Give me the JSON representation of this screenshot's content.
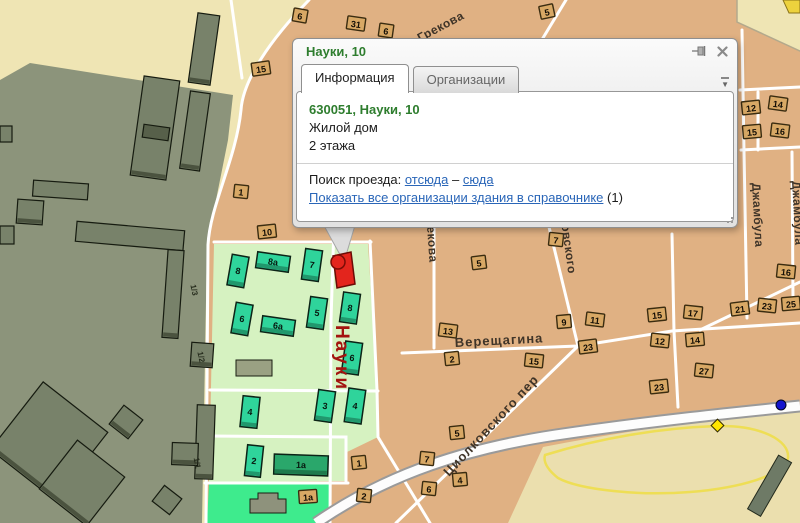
{
  "popup": {
    "title": "Науки, 10",
    "tabs": [
      {
        "label": "Информация",
        "active": true
      },
      {
        "label": "Организации",
        "active": false
      }
    ],
    "address": "630051, Науки, 10",
    "building_type": "Жилой дом",
    "floors": "2 этажа",
    "route_label": "Поиск проезда:",
    "route_from": "отсюда",
    "route_dash": "–",
    "route_to": "сюда",
    "orgs_link": "Показать все организации здания в справочнике",
    "orgs_count": "(1)"
  },
  "colors": {
    "popup_title_green": "#2e7d2e",
    "link_blue": "#2a66b8",
    "street_red": "#a31410",
    "street_dark": "#3f3428",
    "marker_red": "#e3251d",
    "badge_fill": "#d8a865",
    "green_building": "#2fd49b",
    "green_building_dark": "#2aa76b",
    "city_block_tan": "#e0b183",
    "industrial_gray": "#8c947b",
    "residential_green": "#d6f2c1",
    "park_bright_green": "#3eeb8d"
  },
  "map": {
    "street_labels": [
      {
        "t": "Науки",
        "x": 336,
        "y": 325,
        "r": 90,
        "c": "red",
        "s": 19,
        "ls": 2
      },
      {
        "t": "Верещагина",
        "x": 455,
        "y": 347,
        "r": -3,
        "c": "dark",
        "s": 13,
        "ls": 1
      },
      {
        "t": "Циолковского пер",
        "x": 449,
        "y": 477,
        "r": -47,
        "c": "dark",
        "s": 13,
        "ls": 1
      },
      {
        "t": "Циолковского",
        "x": 556,
        "y": 186,
        "r": 82,
        "c": "dark",
        "s": 12,
        "ls": 0.5
      },
      {
        "t": "Грекова",
        "x": 420,
        "y": 42,
        "r": -28,
        "c": "dark",
        "s": 12,
        "ls": 0.5
      },
      {
        "t": "Грекова",
        "x": 426,
        "y": 212,
        "r": 86,
        "c": "dark",
        "s": 12,
        "ls": 0.5
      },
      {
        "t": "Джамбула",
        "x": 752,
        "y": 183,
        "r": 87,
        "c": "dark",
        "s": 12,
        "ls": 0.5
      },
      {
        "t": "Джамбула",
        "x": 792,
        "y": 181,
        "r": 87,
        "c": "dark",
        "s": 12,
        "ls": 0.5
      }
    ],
    "building_badges": [
      {
        "t": "15",
        "x": 261,
        "y": 69,
        "r": -8
      },
      {
        "t": "1",
        "x": 241,
        "y": 192,
        "r": 6
      },
      {
        "t": "10",
        "x": 267,
        "y": 232,
        "r": -6
      },
      {
        "t": "6",
        "x": 300,
        "y": 16,
        "r": 10
      },
      {
        "t": "31",
        "x": 356,
        "y": 24,
        "r": 8
      },
      {
        "t": "6",
        "x": 386,
        "y": 31,
        "r": 8
      },
      {
        "t": "5",
        "x": 547,
        "y": 12,
        "r": -12
      },
      {
        "t": "12",
        "x": 751,
        "y": 108,
        "r": -6
      },
      {
        "t": "14",
        "x": 778,
        "y": 104,
        "r": 8
      },
      {
        "t": "15",
        "x": 752,
        "y": 132,
        "r": -5
      },
      {
        "t": "16",
        "x": 780,
        "y": 131,
        "r": 7
      },
      {
        "t": "5",
        "x": 479,
        "y": 263,
        "r": -7
      },
      {
        "t": "7",
        "x": 556,
        "y": 240,
        "r": 6
      },
      {
        "t": "9",
        "x": 564,
        "y": 322,
        "r": -5
      },
      {
        "t": "11",
        "x": 595,
        "y": 320,
        "r": 7
      },
      {
        "t": "15",
        "x": 657,
        "y": 315,
        "r": -6
      },
      {
        "t": "17",
        "x": 693,
        "y": 313,
        "r": 6
      },
      {
        "t": "21",
        "x": 740,
        "y": 309,
        "r": -7
      },
      {
        "t": "23",
        "x": 767,
        "y": 306,
        "r": 6
      },
      {
        "t": "25",
        "x": 791,
        "y": 304,
        "r": -5
      },
      {
        "t": "13",
        "x": 448,
        "y": 331,
        "r": 7
      },
      {
        "t": "2",
        "x": 452,
        "y": 359,
        "r": -6
      },
      {
        "t": "15",
        "x": 534,
        "y": 361,
        "r": 6
      },
      {
        "t": "23",
        "x": 588,
        "y": 347,
        "r": -7
      },
      {
        "t": "12",
        "x": 660,
        "y": 341,
        "r": 6
      },
      {
        "t": "14",
        "x": 695,
        "y": 340,
        "r": -5
      },
      {
        "t": "27",
        "x": 704,
        "y": 371,
        "r": 6
      },
      {
        "t": "23",
        "x": 659,
        "y": 387,
        "r": -6
      },
      {
        "t": "16",
        "x": 786,
        "y": 272,
        "r": 6
      },
      {
        "t": "5",
        "x": 457,
        "y": 433,
        "r": -6
      },
      {
        "t": "7",
        "x": 427,
        "y": 459,
        "r": 6
      },
      {
        "t": "4",
        "x": 460,
        "y": 480,
        "r": -5
      },
      {
        "t": "6",
        "x": 429,
        "y": 489,
        "r": 6
      },
      {
        "t": "1",
        "x": 359,
        "y": 463,
        "r": -6
      },
      {
        "t": "2",
        "x": 364,
        "y": 496,
        "r": 6
      },
      {
        "t": "1а",
        "x": 308,
        "y": 497,
        "r": -4
      }
    ],
    "green_buildings": [
      {
        "t": "8",
        "x": 238,
        "y": 271,
        "w": 17,
        "h": 31,
        "r": 10
      },
      {
        "t": "8а",
        "x": 273,
        "y": 262,
        "w": 33,
        "h": 16,
        "r": 8
      },
      {
        "t": "7",
        "x": 312,
        "y": 265,
        "w": 17,
        "h": 31,
        "r": 8
      },
      {
        "t": "5",
        "x": 317,
        "y": 313,
        "w": 17,
        "h": 31,
        "r": 8
      },
      {
        "t": "8",
        "x": 350,
        "y": 308,
        "w": 17,
        "h": 30,
        "r": 8
      },
      {
        "t": "6",
        "x": 242,
        "y": 319,
        "w": 17,
        "h": 31,
        "r": 10
      },
      {
        "t": "6а",
        "x": 278,
        "y": 326,
        "w": 33,
        "h": 16,
        "r": 8
      },
      {
        "t": "6",
        "x": 352,
        "y": 358,
        "w": 17,
        "h": 32,
        "r": 8
      },
      {
        "t": "4",
        "x": 250,
        "y": 412,
        "w": 17,
        "h": 31,
        "r": 6
      },
      {
        "t": "3",
        "x": 325,
        "y": 406,
        "w": 17,
        "h": 31,
        "r": 8
      },
      {
        "t": "4",
        "x": 355,
        "y": 406,
        "w": 17,
        "h": 34,
        "r": 8
      },
      {
        "t": "2",
        "x": 254,
        "y": 461,
        "w": 16,
        "h": 31,
        "r": 6
      },
      {
        "t": "1а",
        "x": 301,
        "y": 465,
        "w": 54,
        "h": 20,
        "r": 2,
        "v": "dark"
      }
    ],
    "industrial_labels": [
      {
        "t": "1/3",
        "x": 194,
        "y": 290,
        "r": 78
      },
      {
        "t": "1/2",
        "x": 201,
        "y": 357,
        "r": 78
      },
      {
        "t": "1/1",
        "x": 197,
        "y": 463,
        "r": 80
      }
    ]
  }
}
